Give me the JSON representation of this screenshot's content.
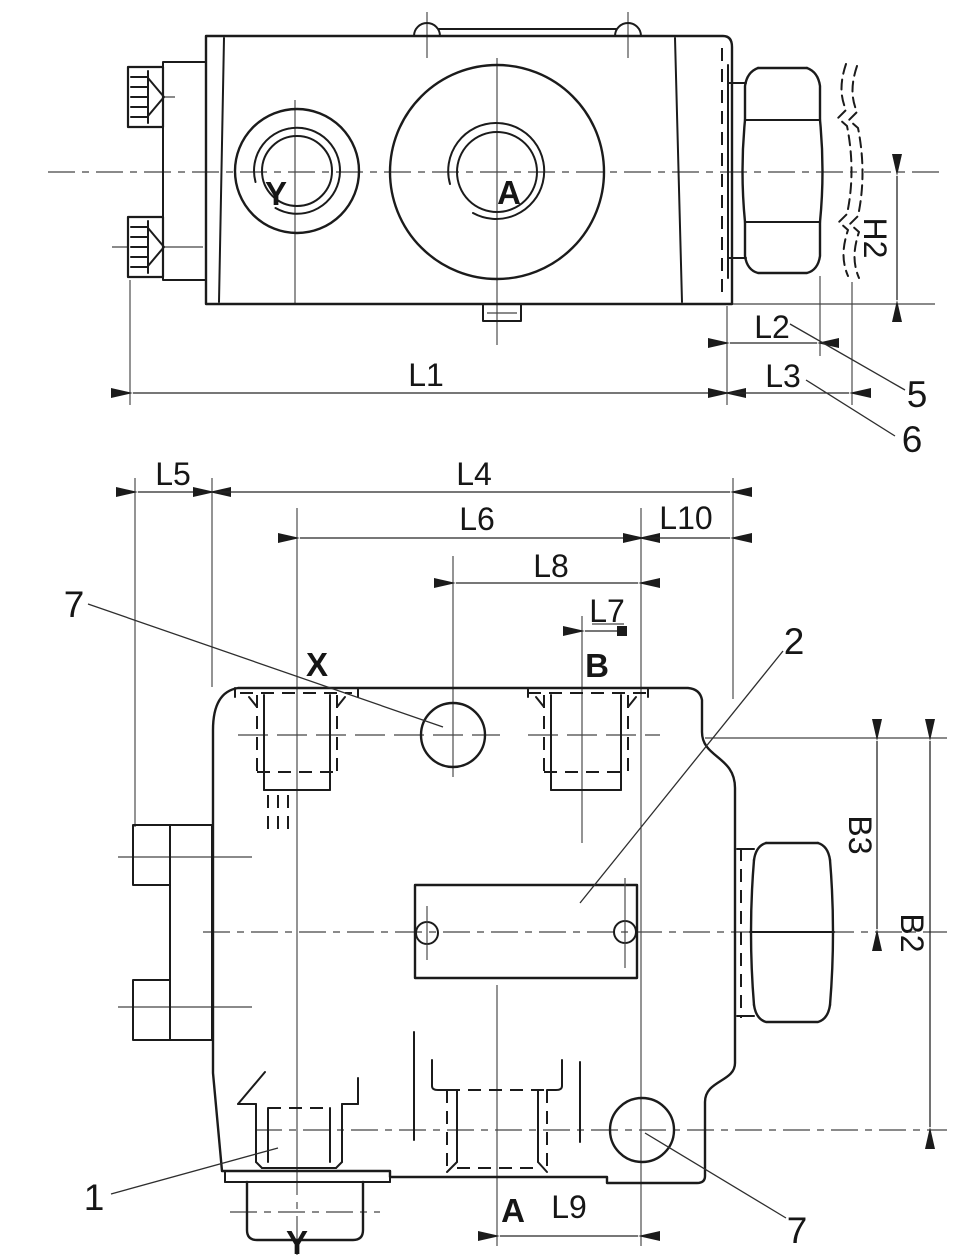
{
  "colors": {
    "line": "#1b1b1b",
    "thin_line": "#454545",
    "background": "#ffffff"
  },
  "top_view": {
    "port_labels": {
      "y": "Y",
      "a": "A"
    },
    "dimensions": {
      "h2": "H2",
      "l1": "L1",
      "l2": "L2",
      "l3": "L3"
    },
    "callouts": {
      "n5": "5",
      "n6": "6"
    }
  },
  "front_view": {
    "port_labels": {
      "x": "X",
      "b": "B",
      "a": "A",
      "y": "Y"
    },
    "dimensions": {
      "l4": "L4",
      "l5": "L5",
      "l6": "L6",
      "l7": "L7",
      "l8": "L8",
      "l9": "L9",
      "l10": "L10",
      "b2": "B2",
      "b3": "B3"
    },
    "callouts": {
      "n1": "1",
      "n2": "2",
      "n7_top": "7",
      "n7_bottom": "7"
    }
  }
}
